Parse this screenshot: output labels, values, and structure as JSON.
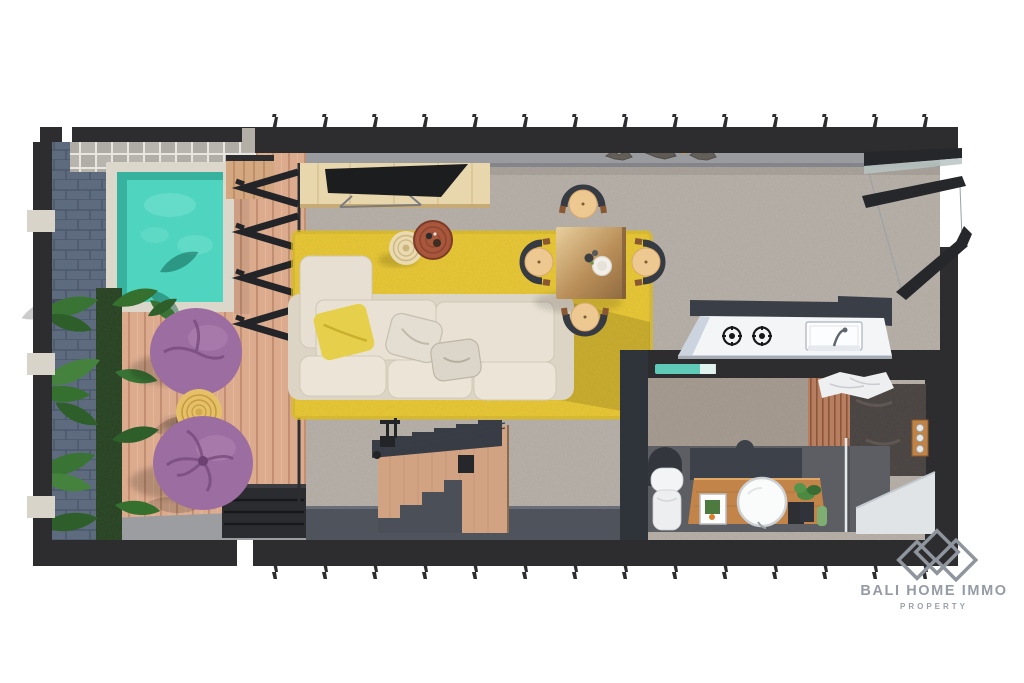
{
  "meta": {
    "type": "3d-floor-plan-render",
    "view": "top-down cutaway villa floor plan",
    "canvas": {
      "width": 1024,
      "height": 683
    }
  },
  "watermark": {
    "brand": "BALI HOME IMMO",
    "tagline": "PROPERTY",
    "logo_icon": "three-diamond-outline",
    "text_color": "#959ba4"
  },
  "palette": {
    "background": "#ffffff",
    "wall": "#2d2d30",
    "wall_inner_top": "#999b9e",
    "wall_inner_bottom": "#4f535c",
    "floor_concrete": "#b7b1a9",
    "bathroom_wall_concrete": "#a79d92",
    "deck_wood": "#dcab8e",
    "pool_water": "#4fd4c0",
    "pool_water_deep": "#2ea794",
    "pool_coping": "#dcd7cb",
    "pavers": "#b7b5ad",
    "stone_wall_blue": "#5d6c81",
    "plant_green": "#3a7435",
    "plant_green_dark": "#2e5f2a",
    "planting_bed": "#23421f",
    "beanbag_purple": "#9c6da0",
    "beanbag_crease": "#7a4d80",
    "side_table_rattan": "#e5c068",
    "rug_yellow": "#eac933",
    "sofa_cream": "#e9e2d4",
    "sofa_frame": "#dcd4c4",
    "pillow_yellow": "#e6cf4a",
    "tv_console_wood": "#e8d6ac",
    "tv_screen": "#1c1d1f",
    "coffee_table_wood": "#a8573c",
    "coffee_table_rattan": "#e9dab2",
    "dining_table_wood": "#b98e58",
    "chair_seat_wood": "#eec891",
    "chair_back": "#363a42",
    "kitchen_counter": "#f3f5f7",
    "kitchen_counter_side": "#ccd5df",
    "bathroom_floor": "#5b5e64",
    "slat_wall_wood": "#b87e60",
    "stone_feature_wall": "#474240",
    "vanity_wood": "#c28449",
    "fixture_white": "#f2f4f5",
    "glass_teal": "#5fcab8",
    "shower_tray": "#e0e4e7",
    "stair_wood": "#d2a382",
    "stair_tread_dark": "#383c44"
  },
  "scene": {
    "areas": [
      {
        "name": "pool-terrace",
        "items": [
          "plunge-pool",
          "paver-border",
          "stone-accent-wall",
          "wood-deck",
          "tropical-plants",
          "bean-bag",
          "bean-bag",
          "rattan-side-table",
          "entry-steps"
        ]
      },
      {
        "name": "living-room",
        "items": [
          "folding-glass-door",
          "tv-console",
          "tv",
          "yellow-area-rug",
          "sectional-sofa",
          "yellow-pillow",
          "white-pillows",
          "rattan-coffee-table",
          "wood-coffee-table"
        ]
      },
      {
        "name": "dining-area",
        "items": [
          "square-dining-table",
          "dining-chair",
          "dining-chair",
          "dining-chair",
          "dining-chair",
          "table-setting"
        ]
      },
      {
        "name": "kitchen",
        "items": [
          "counter",
          "gas-burner",
          "gas-burner",
          "sink",
          "faucet",
          "bi-fold-window"
        ]
      },
      {
        "name": "bathroom",
        "items": [
          "toilet",
          "wood-vanity",
          "round-mirror",
          "framed-picture",
          "plant",
          "slat-wall",
          "stone-shower-wall",
          "shower-controls",
          "glass-partition",
          "shower-tray",
          "towels"
        ]
      },
      {
        "name": "staircase",
        "items": [
          "wood-stair-panel",
          "dark-treads",
          "handrail"
        ]
      }
    ],
    "counts": {
      "bean_bags": 2,
      "dining_chairs": 4,
      "gas_burners": 2,
      "coffee_tables": 2,
      "pools": 1
    }
  }
}
